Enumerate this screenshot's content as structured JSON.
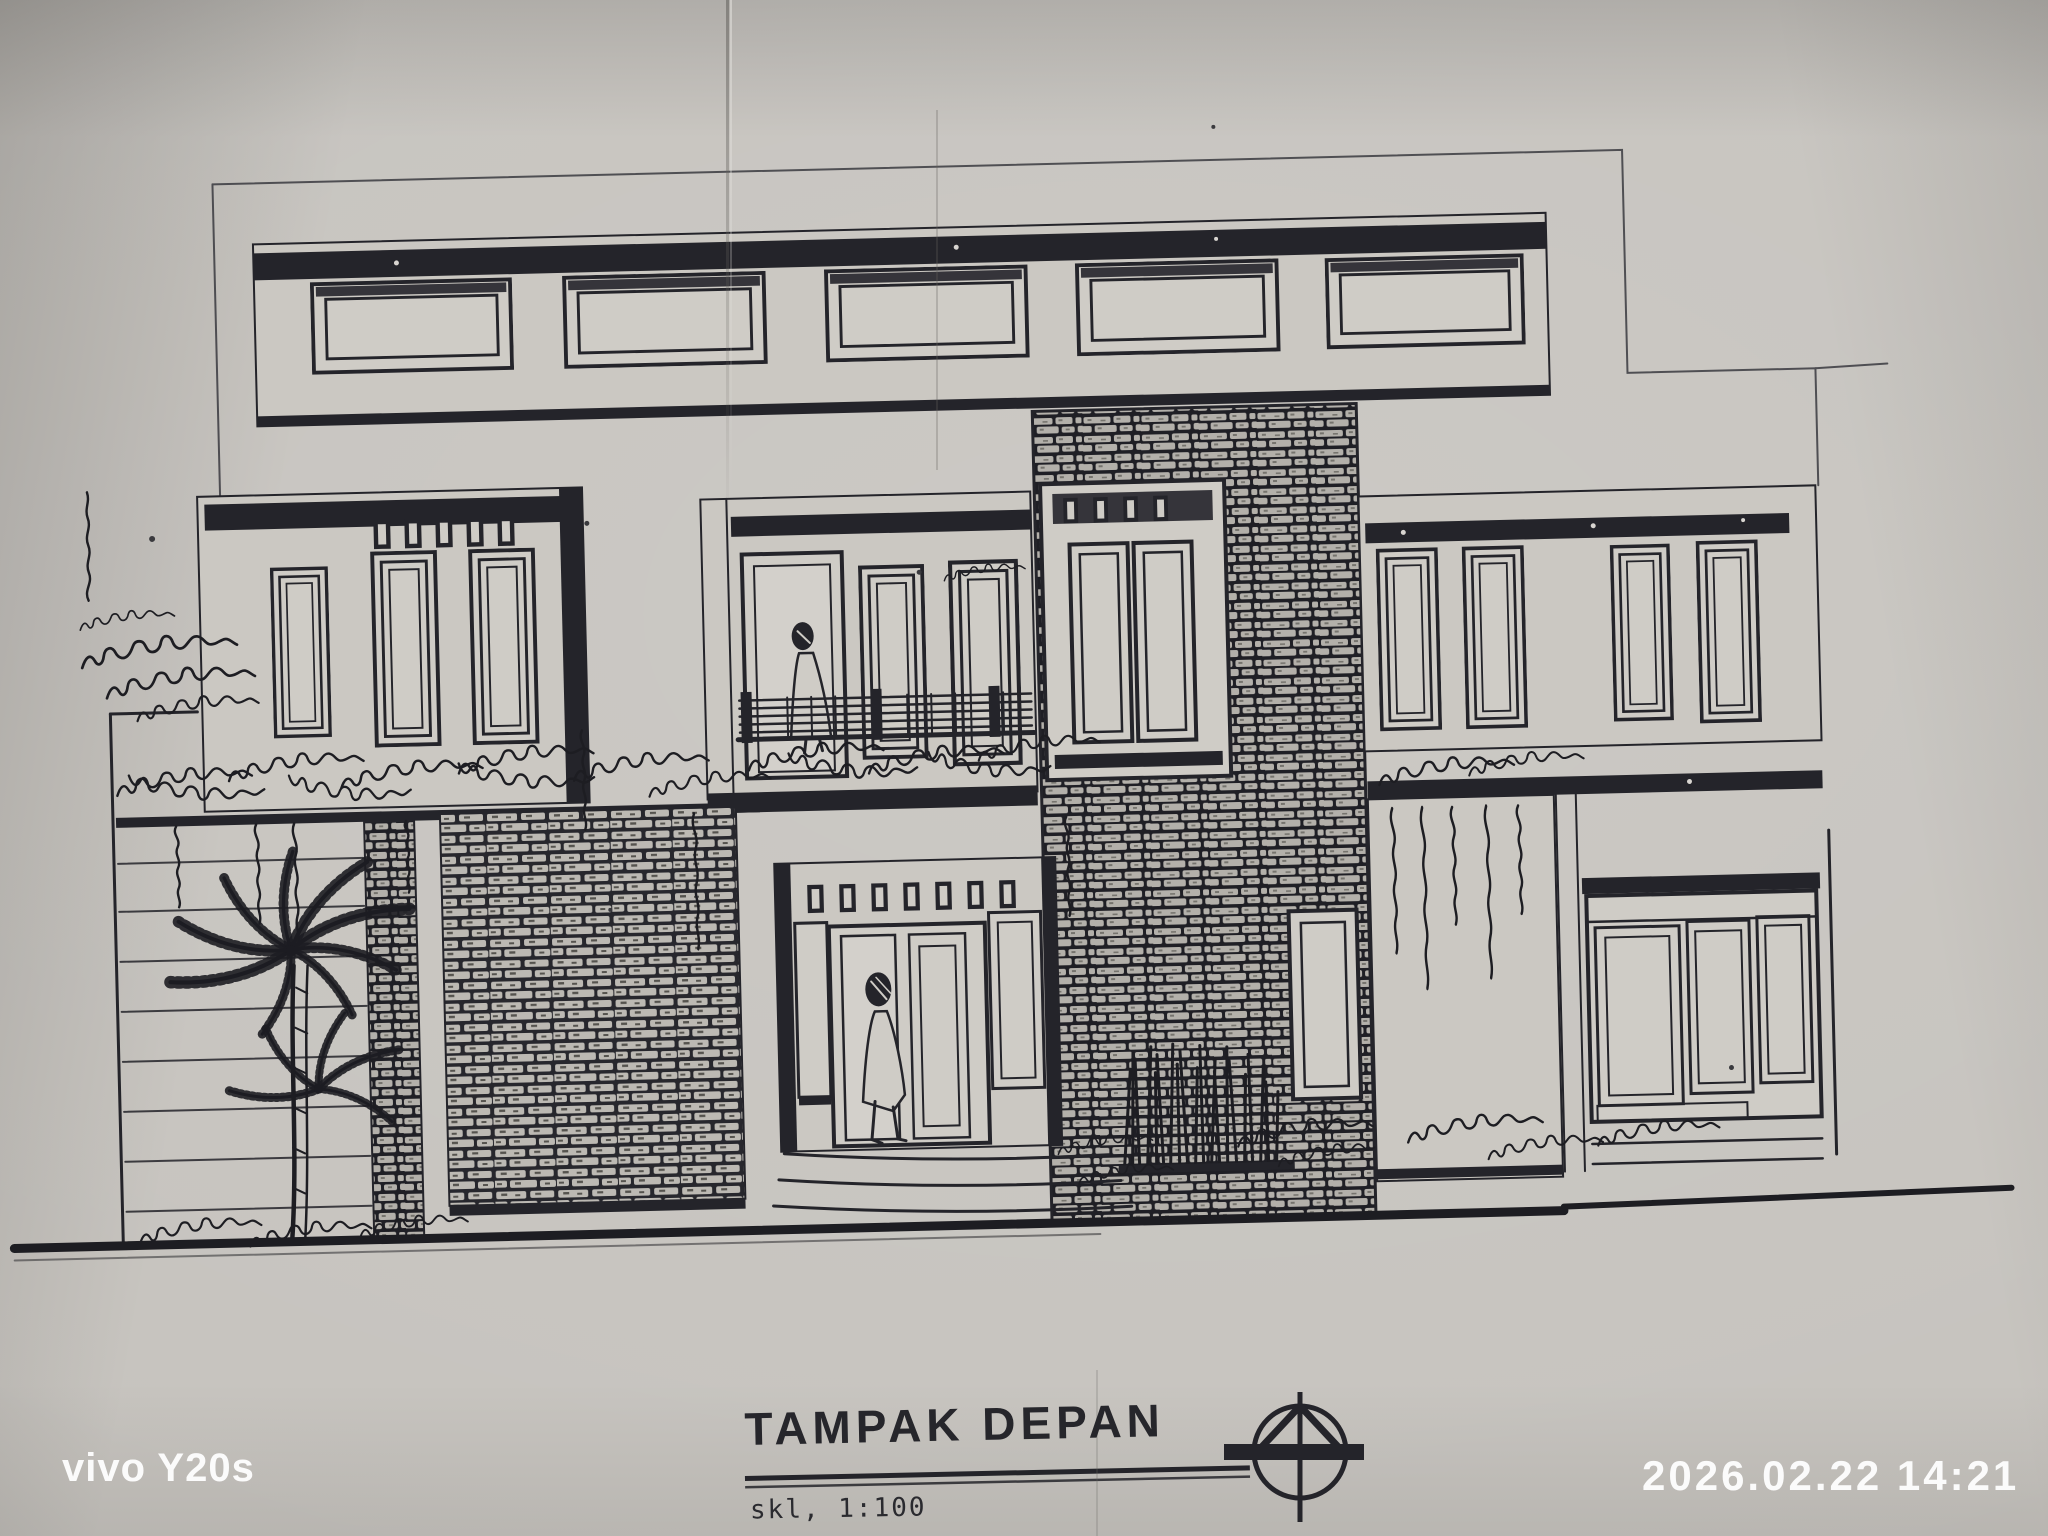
{
  "title_block": {
    "title": "TAMPAK DEPAN",
    "scale_label": "skl, 1:100"
  },
  "camera_overlay": {
    "watermark": "vivo Y20s",
    "timestamp": "2026.02.22 14:21",
    "text_color": "#ffffff"
  },
  "colors": {
    "paper": "#c6c3be",
    "ink": "#24242a"
  }
}
